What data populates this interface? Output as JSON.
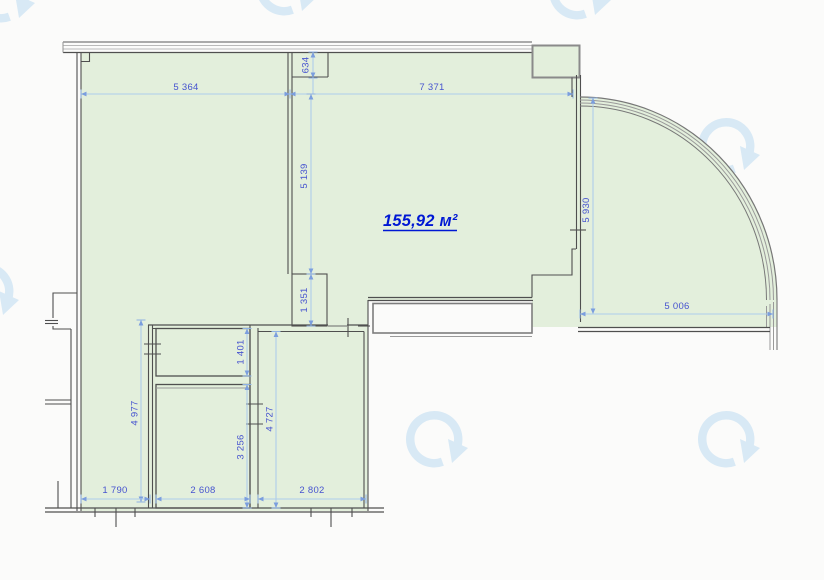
{
  "plan": {
    "area_label": "155,92 м²",
    "dimensions": {
      "d_5364": "5 364",
      "d_7371": "7 371",
      "d_634": "634",
      "d_5139": "5 139",
      "d_1351": "1 351",
      "d_5930": "5 930",
      "d_5006": "5 006",
      "d_4977": "4 977",
      "d_1401": "1 401",
      "d_3256": "3 256",
      "d_4727": "4 727",
      "d_1790": "1 790",
      "d_2608": "2 608",
      "d_2802": "2 802"
    },
    "colors": {
      "floor_fill": "#e3efdc",
      "wall_dark": "#4f4f4f",
      "wall_light": "#9a9a9a",
      "dimension_line": "#aecdec",
      "dimension_text": "#4653cf",
      "area_text": "#0018d4",
      "watermark": "#d8e9f5",
      "background": "#fbfbfa"
    },
    "watermark_icon": "circular-arrow-logo"
  }
}
